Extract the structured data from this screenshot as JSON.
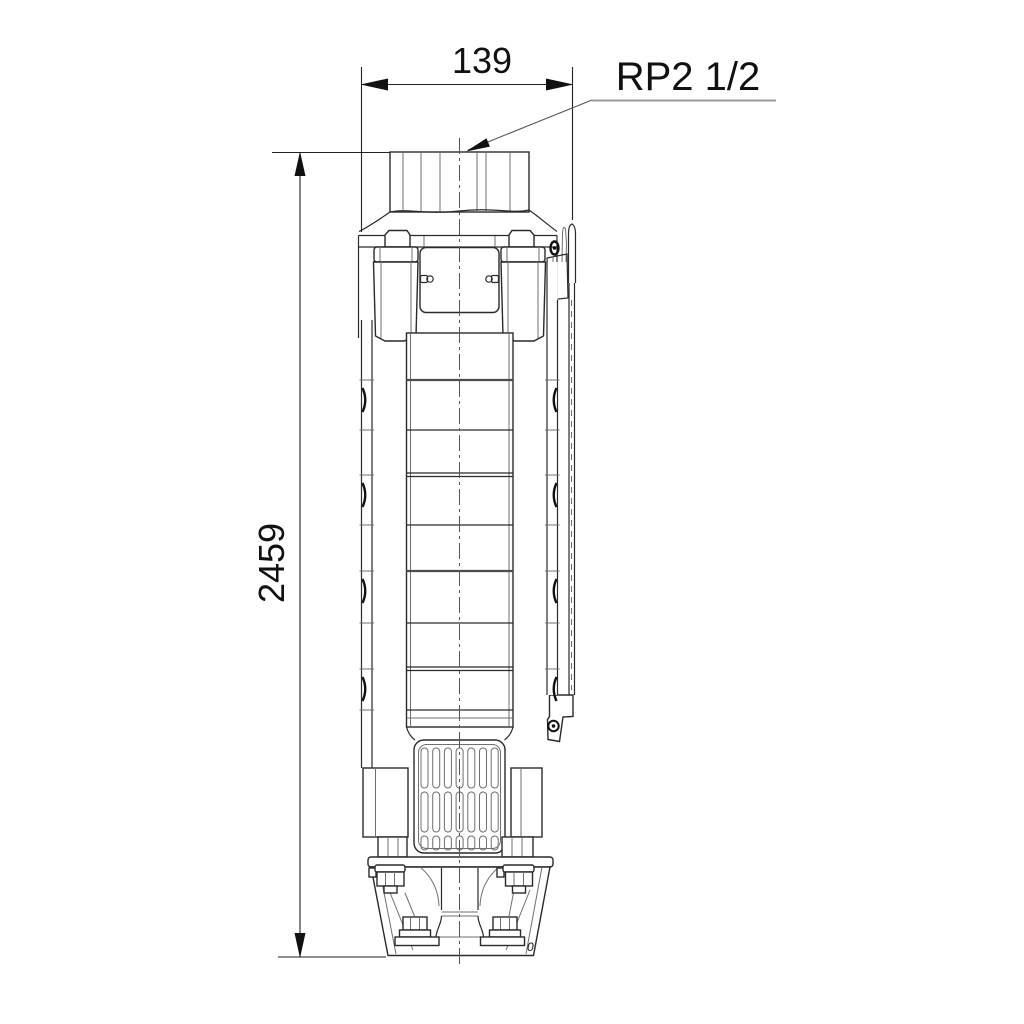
{
  "drawing": {
    "background_color": "#ffffff",
    "line_color": "#2a2a2a"
  },
  "labels": {
    "width_mm": "139",
    "height_mm": "2459",
    "connection_thread": "RP2 1/2",
    "base_mark": "0"
  }
}
